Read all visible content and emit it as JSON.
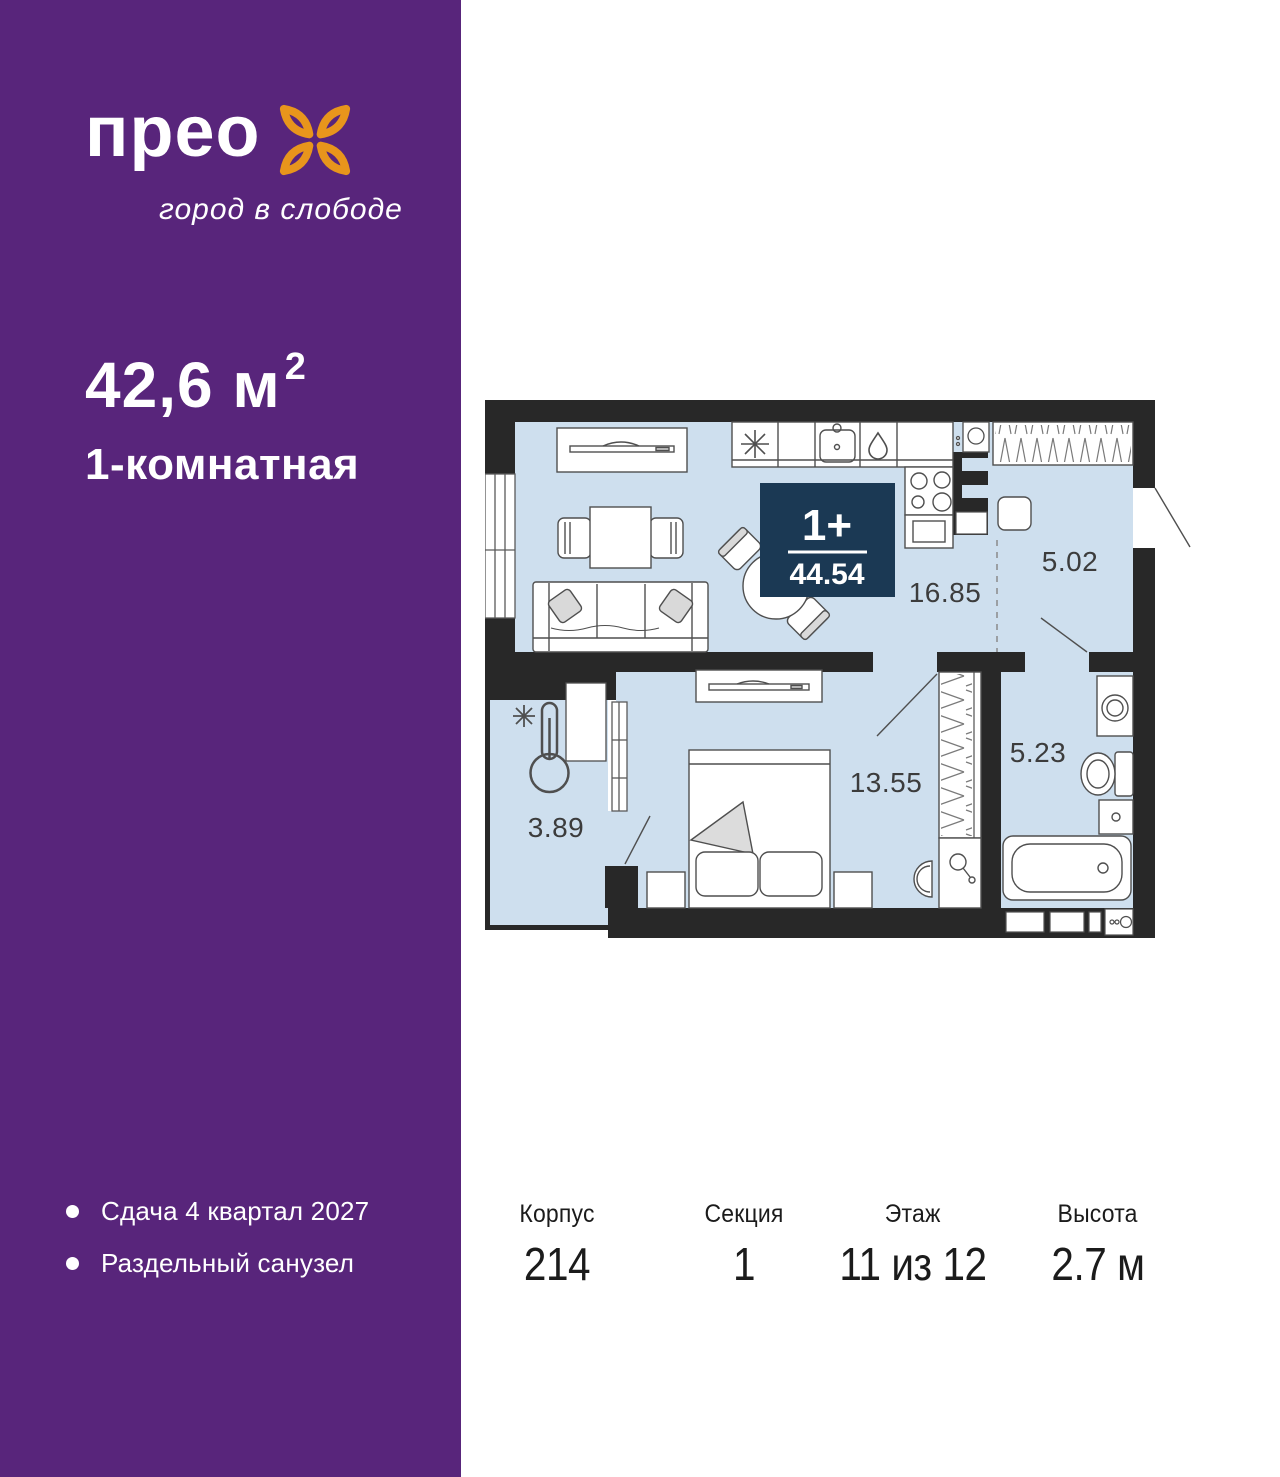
{
  "colors": {
    "sidebar_purple": "#58257B",
    "logo_orange": "#E8951C",
    "badge_navy": "#1B3954",
    "floor_blue": "#CEDFEE",
    "wall_dark": "#282828"
  },
  "brand": {
    "name": "прео",
    "tagline": "город в слободе",
    "logo_icon": "four-petal-flower-icon"
  },
  "listing": {
    "area_value": "42,6",
    "area_unit": "м",
    "area_sup": "2",
    "rooms_label": "1-комнатная"
  },
  "features": [
    {
      "label": "Сдача 4 квартал 2027"
    },
    {
      "label": "Раздельный санузел"
    }
  ],
  "plan": {
    "badge": {
      "type": "1+",
      "total_area": "44.54"
    },
    "room_areas": {
      "living_kitchen": "16.85",
      "hallway": "5.02",
      "bedroom": "13.55",
      "bathroom": "5.23",
      "balcony": "3.89"
    },
    "icons": [
      "snowflake-fridge-icon",
      "water-drop-icon",
      "thermometer-cold-icon",
      "mirror-icon",
      "washer-icon",
      "wardrobe-hatch"
    ]
  },
  "details": [
    {
      "label": "Корпус",
      "value": "214"
    },
    {
      "label": "Секция",
      "value": "1"
    },
    {
      "label": "Этаж",
      "value": "11 из 12"
    },
    {
      "label": "Высота",
      "value": "2.7 м"
    }
  ]
}
